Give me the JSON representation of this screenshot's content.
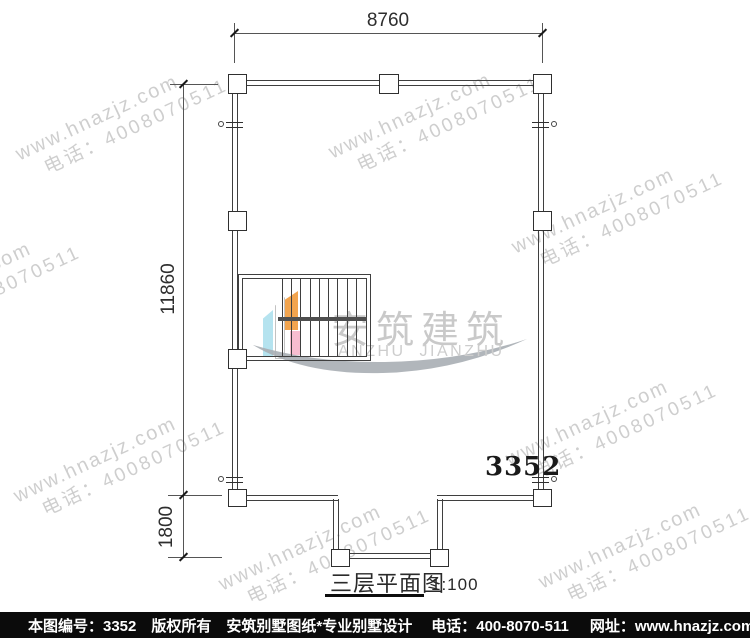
{
  "watermark": {
    "line1": "www.hnazjz.com",
    "line2": "电话：4008070511",
    "color": "#c3c3c3"
  },
  "logo": {
    "cn": "安筑建筑",
    "en": "ANZHU  JIANZHU",
    "colors": {
      "blue": "#b5e3ef",
      "orange": "#f2a44e",
      "pink": "#f8bdd0",
      "swoosh": "#a8aeb4",
      "text": "#c9c9c9"
    }
  },
  "dims": {
    "top": "8760",
    "left": "11860",
    "bottom": "1800"
  },
  "plan": {
    "number": "3352",
    "title": "三层平面图",
    "scale": "1:100"
  },
  "footer": {
    "items": [
      "本图编号：3352",
      "版权所有",
      "安筑别墅图纸*专业别墅设计",
      "电话：400-8070-511",
      "网址：www.hnazjz.com"
    ],
    "bg": "#0b0b0b"
  }
}
